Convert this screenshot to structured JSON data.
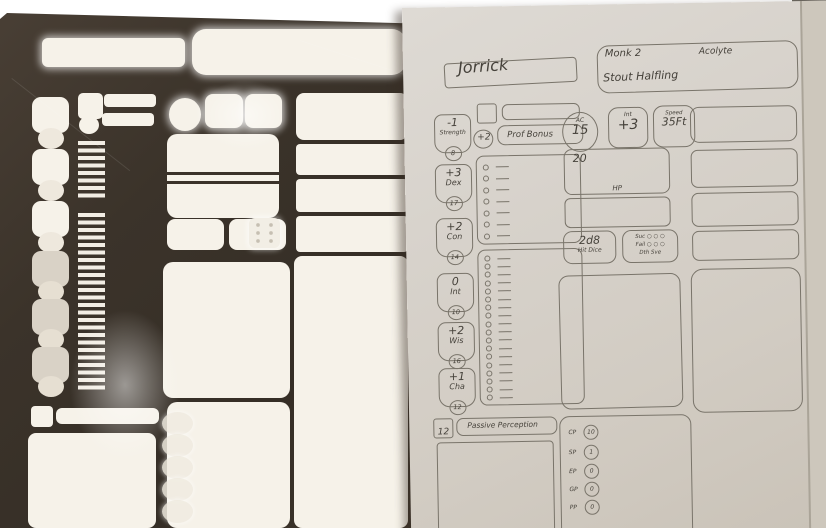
{
  "colors": {
    "stencil": "#3b332a",
    "paper": "#d6d1c9",
    "ink": "#45413a",
    "line": "#79746a"
  },
  "sheet": {
    "name": "Jorrick",
    "class_level": "Monk 2",
    "background": "Acolyte",
    "race": "Stout Halfling",
    "inspiration": "",
    "proficiency": {
      "bonus": "+2",
      "label": "Prof Bonus"
    },
    "abilities": [
      {
        "mod": "-1",
        "name": "Strength",
        "score": "8"
      },
      {
        "mod": "+3",
        "name": "Dex",
        "score": "17"
      },
      {
        "mod": "+2",
        "name": "Con",
        "score": "14"
      },
      {
        "mod": "0",
        "name": "Int",
        "score": "10"
      },
      {
        "mod": "+2",
        "name": "Wis",
        "score": "16"
      },
      {
        "mod": "+1",
        "name": "Cha",
        "score": "12"
      }
    ],
    "combat": {
      "ac_label": "AC",
      "ac": "15",
      "init_label": "Int",
      "init": "+3",
      "speed_label": "Speed",
      "speed": "35Ft"
    },
    "hp": {
      "current": "20",
      "label": "HP"
    },
    "hit_dice": {
      "value": "2d8",
      "label": "Hit Dice"
    },
    "death_saves": {
      "success_label": "Suc",
      "fail_label": "Fail",
      "label": "Dth Sve",
      "success_circles": 3,
      "fail_circles": 3
    },
    "passive_perception": {
      "value": "12",
      "label": "Passive Perception"
    },
    "currency": [
      {
        "label": "CP",
        "value": "10"
      },
      {
        "label": "SP",
        "value": "1"
      },
      {
        "label": "EP",
        "value": "0"
      },
      {
        "label": "GP",
        "value": "0"
      },
      {
        "label": "PP",
        "value": "0"
      }
    ],
    "saving_throw_rows": 7,
    "skill_rows": 18
  },
  "stencil": {
    "die_pips": 6,
    "currency_circles": 5,
    "ability_cutouts": 6
  }
}
